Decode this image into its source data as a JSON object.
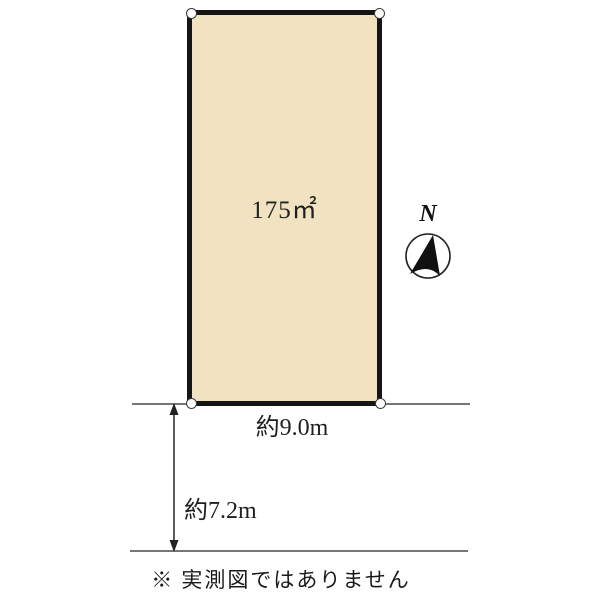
{
  "plot": {
    "area_label": "175㎡",
    "width_label": "約9.0m",
    "depth_label": "約7.2m"
  },
  "compass": {
    "label": "N"
  },
  "footer": {
    "disclaimer": "※ 実測図ではありません"
  },
  "colors": {
    "plot_fill": "#f1e2c1",
    "plot_border": "#151515",
    "boundary_line": "#777777",
    "text": "#1f1f1f"
  }
}
